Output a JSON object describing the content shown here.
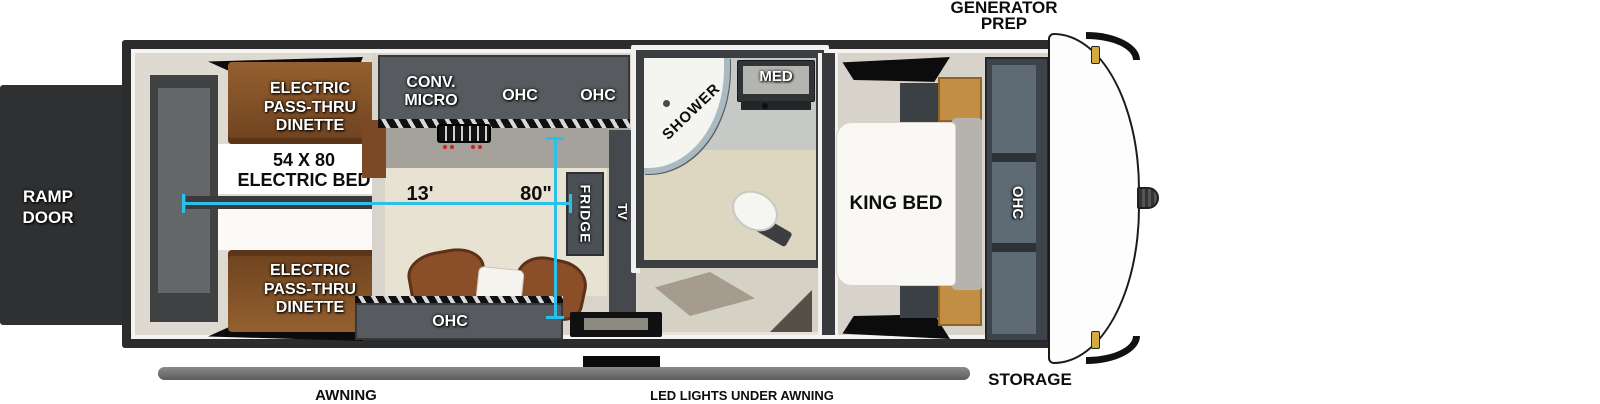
{
  "captions": {
    "generator_prep": [
      "GENERATOR",
      "PREP"
    ],
    "storage": "STORAGE",
    "awning": "AWNING",
    "led_lights": "LED LIGHTS UNDER AWNING",
    "ramp_door": [
      "RAMP",
      "DOOR"
    ]
  },
  "garage": {
    "dinette_top": [
      "ELECTRIC",
      "PASS-THRU",
      "DINETTE"
    ],
    "dinette_bottom": [
      "ELECTRIC",
      "PASS-THRU",
      "DINETTE"
    ],
    "bed_label": [
      "54 X 80",
      "ELECTRIC BED"
    ]
  },
  "kitchen": {
    "cabinet_label": [
      "CONV.",
      "MICRO"
    ],
    "ohc_left": "OHC",
    "ohc_right": "OHC",
    "ohc_bottom": "OHC",
    "fridge": "FRIDGE",
    "tv": "TV"
  },
  "bathroom": {
    "shower": "SHOWER",
    "med": "MED"
  },
  "bedroom": {
    "bed": "KING BED",
    "ohc_wardrobe": "OHC"
  },
  "dimensions": {
    "garage_length": "13'",
    "interior_width": "80\""
  },
  "colors": {
    "dimension_accent": "#2bc0ea",
    "wood": "#8a5730",
    "cabinet_gray": "#575b5f",
    "frame_dark": "#2b2c2e"
  }
}
